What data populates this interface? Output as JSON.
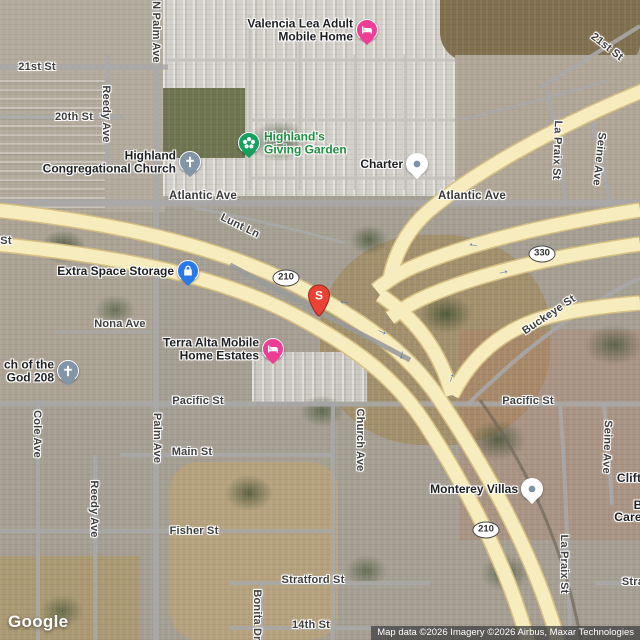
{
  "map": {
    "logo": "Google",
    "attribution": "Map data ©2026 Imagery ©2026 Airbus, Maxar Technologies",
    "colors": {
      "freeway": "#f6ecbd",
      "freeway_casing": "#d5bf82",
      "local_road": "#a8a8a8",
      "street_text": "#3f3f3f",
      "poi_text": "#1d1f22",
      "park_text": "#1d8e3f",
      "marker_red": "#ea4335",
      "lodging_pink": "#ed3d95",
      "church_gray": "#8296a8",
      "storage_blue": "#2979e8",
      "park_green": "#14a05f",
      "generic_pin_white": "#ffffff",
      "arrow_blue": "#4d79b5"
    },
    "marker": {
      "label": "S",
      "x": 319,
      "y": 317
    },
    "route_shields": [
      {
        "text": "210",
        "x": 286,
        "y": 278
      },
      {
        "text": "330",
        "x": 542,
        "y": 254
      },
      {
        "text": "210",
        "x": 486,
        "y": 530
      }
    ],
    "street_labels": [
      {
        "text": "21st St",
        "x": 37,
        "y": 67,
        "rotate": 0
      },
      {
        "text": "20th St",
        "x": 74,
        "y": 117,
        "rotate": 0
      },
      {
        "text": "Reedy Ave",
        "x": 106,
        "y": 114,
        "rotate": 90
      },
      {
        "text": "N Palm Ave",
        "x": 156,
        "y": 32,
        "rotate": 90
      },
      {
        "text": "Atlantic Ave",
        "x": 203,
        "y": 196,
        "rotate": 0,
        "major": true
      },
      {
        "text": "Atlantic Ave",
        "x": 472,
        "y": 196,
        "rotate": 0,
        "major": true
      },
      {
        "text": "Lunt Ln",
        "x": 240,
        "y": 226,
        "rotate": 26
      },
      {
        "text": "21st St",
        "x": 607,
        "y": 47,
        "rotate": 38
      },
      {
        "text": "La Praix St",
        "x": 557,
        "y": 150,
        "rotate": 92
      },
      {
        "text": "Seine Ave",
        "x": 599,
        "y": 159,
        "rotate": 96
      },
      {
        "text": "St",
        "x": 6,
        "y": 241,
        "rotate": 0
      },
      {
        "text": "Nona Ave",
        "x": 120,
        "y": 324,
        "rotate": 0
      },
      {
        "text": "Pacific St",
        "x": 198,
        "y": 401,
        "rotate": 0
      },
      {
        "text": "Pacific St",
        "x": 528,
        "y": 401,
        "rotate": 0
      },
      {
        "text": "Cole Ave",
        "x": 37,
        "y": 434,
        "rotate": 90
      },
      {
        "text": "Palm Ave",
        "x": 157,
        "y": 438,
        "rotate": 90
      },
      {
        "text": "Main St",
        "x": 192,
        "y": 452,
        "rotate": 0
      },
      {
        "text": "Church Ave",
        "x": 360,
        "y": 440,
        "rotate": 90
      },
      {
        "text": "Reedy Ave",
        "x": 94,
        "y": 509,
        "rotate": 90
      },
      {
        "text": "Fisher St",
        "x": 194,
        "y": 531,
        "rotate": 0
      },
      {
        "text": "Buckeye St",
        "x": 549,
        "y": 315,
        "rotate": -34
      },
      {
        "text": "Seine Ave",
        "x": 607,
        "y": 447,
        "rotate": 92
      },
      {
        "text": "La Praix St",
        "x": 564,
        "y": 564,
        "rotate": 90
      },
      {
        "text": "Stratford St",
        "x": 313,
        "y": 580,
        "rotate": 0
      },
      {
        "text": "Bonita Dr",
        "x": 257,
        "y": 615,
        "rotate": 90
      },
      {
        "text": "14th St",
        "x": 311,
        "y": 625,
        "rotate": 0
      },
      {
        "text": "Clift",
        "x": 629,
        "y": 478,
        "rotate": 0,
        "kind": "poi-frag"
      },
      {
        "text": "B",
        "x": 638,
        "y": 505,
        "rotate": 0,
        "kind": "poi-frag"
      },
      {
        "text": "Care",
        "x": 628,
        "y": 517,
        "rotate": 0,
        "kind": "poi-frag"
      },
      {
        "text": "Stra",
        "x": 633,
        "y": 582,
        "rotate": 0
      }
    ],
    "pois": [
      {
        "name": "valencia-lea-adult-mobile-home",
        "lines": [
          "Valencia Lea Adult",
          "Mobile Home"
        ],
        "icon": "bed",
        "color": "#ed3d95",
        "x": 367,
        "y": 30,
        "side": "left"
      },
      {
        "name": "highland-congregational-church",
        "lines": [
          "Highland",
          "Congregational Church"
        ],
        "icon": "cross",
        "color": "#8296a8",
        "x": 190,
        "y": 162,
        "side": "left"
      },
      {
        "name": "highlands-giving-garden",
        "lines": [
          "Highland's",
          "Giving Garden"
        ],
        "icon": "flower",
        "color": "#14a05f",
        "x": 249,
        "y": 143,
        "side": "right",
        "text_color": "#1d8e3f"
      },
      {
        "name": "charter",
        "lines": [
          "Charter"
        ],
        "icon": "dot",
        "color": "#ffffff",
        "x": 417,
        "y": 164,
        "side": "left"
      },
      {
        "name": "extra-space-storage",
        "lines": [
          "Extra Space Storage"
        ],
        "icon": "lock",
        "color": "#2979e8",
        "x": 188,
        "y": 271,
        "side": "left"
      },
      {
        "name": "terra-alta-mobile-home-estates",
        "lines": [
          "Terra Alta Mobile",
          "Home Estates"
        ],
        "icon": "bed",
        "color": "#ed3d95",
        "x": 273,
        "y": 349,
        "side": "left"
      },
      {
        "name": "church-of-the-god-208",
        "lines": [
          "ch of the",
          "God 208"
        ],
        "icon": "cross",
        "color": "#8296a8",
        "x": 68,
        "y": 371,
        "side": "left"
      },
      {
        "name": "monterey-villas",
        "lines": [
          "Monterey Villas"
        ],
        "icon": "dot",
        "color": "#ffffff",
        "x": 532,
        "y": 489,
        "side": "left"
      }
    ],
    "flow_arrows": [
      {
        "glyph": "←",
        "x": 345,
        "y": 300,
        "rotate": 8
      },
      {
        "glyph": "←",
        "x": 474,
        "y": 243,
        "rotate": 12
      },
      {
        "glyph": "→",
        "x": 503,
        "y": 270,
        "rotate": -12
      },
      {
        "glyph": "→",
        "x": 383,
        "y": 330,
        "rotate": 25
      },
      {
        "glyph": "↓",
        "x": 402,
        "y": 354,
        "rotate": 15
      },
      {
        "glyph": "↑",
        "x": 452,
        "y": 377,
        "rotate": 20
      }
    ]
  }
}
